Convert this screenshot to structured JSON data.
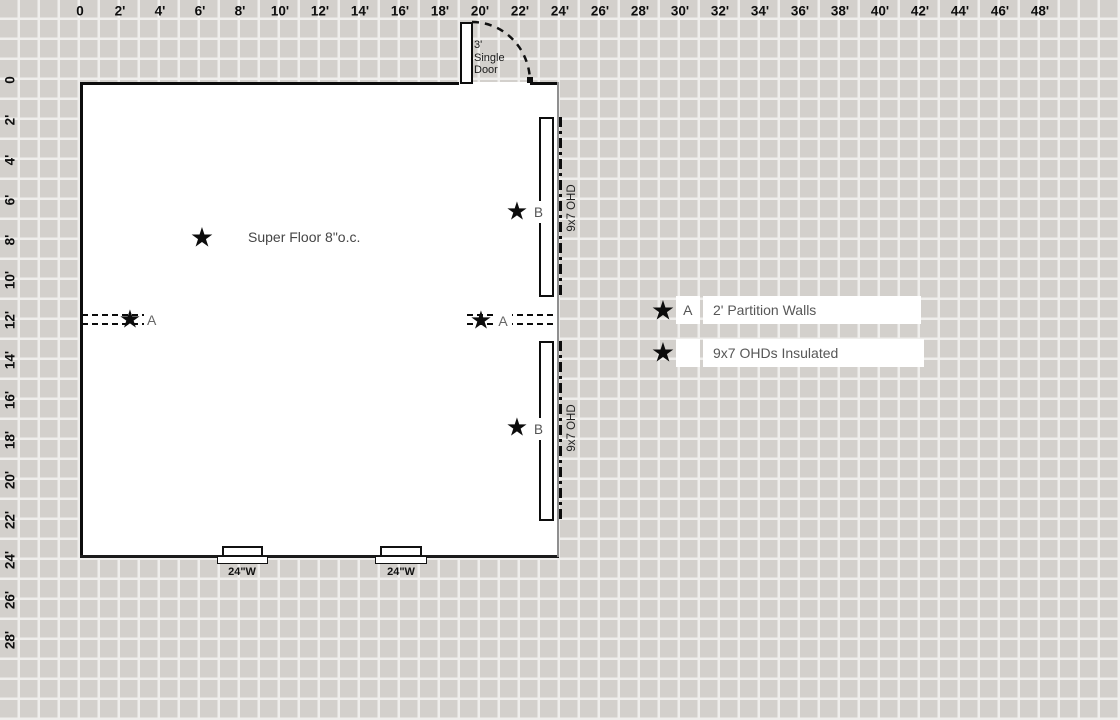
{
  "icons": {
    "star": "★"
  },
  "rulers": {
    "top": [
      "0",
      "2'",
      "4'",
      "6'",
      "8'",
      "10'",
      "12'",
      "14'",
      "16'",
      "18'",
      "20'",
      "22'",
      "24'",
      "26'",
      "28'",
      "30'",
      "32'",
      "34'",
      "36'",
      "38'",
      "40'",
      "42'",
      "44'",
      "46'",
      "48'"
    ],
    "left": [
      "0",
      "2'",
      "4'",
      "6'",
      "8'",
      "10'",
      "12'",
      "14'",
      "16'",
      "18'",
      "20'",
      "22'",
      "24'",
      "26'",
      "28'"
    ]
  },
  "plan": {
    "door_label": [
      "3'",
      "Single",
      "Door"
    ],
    "floor_note": "Super Floor 8\"o.c.",
    "partition_label": "A",
    "ohd_label": "B",
    "ohd_side_label": "9x7 OHD",
    "window_labels": [
      "24\"W",
      "24\"W"
    ]
  },
  "legend": {
    "rows": [
      {
        "key": "A",
        "label": "2' Partition Walls"
      },
      {
        "key": "",
        "label": "9x7 OHDs Insulated"
      }
    ]
  },
  "colors": {
    "grid_cell": "#d3d0cc",
    "grid_line": "#efeeec",
    "wall": "#0d0d0d",
    "muted_text": "#575757"
  }
}
